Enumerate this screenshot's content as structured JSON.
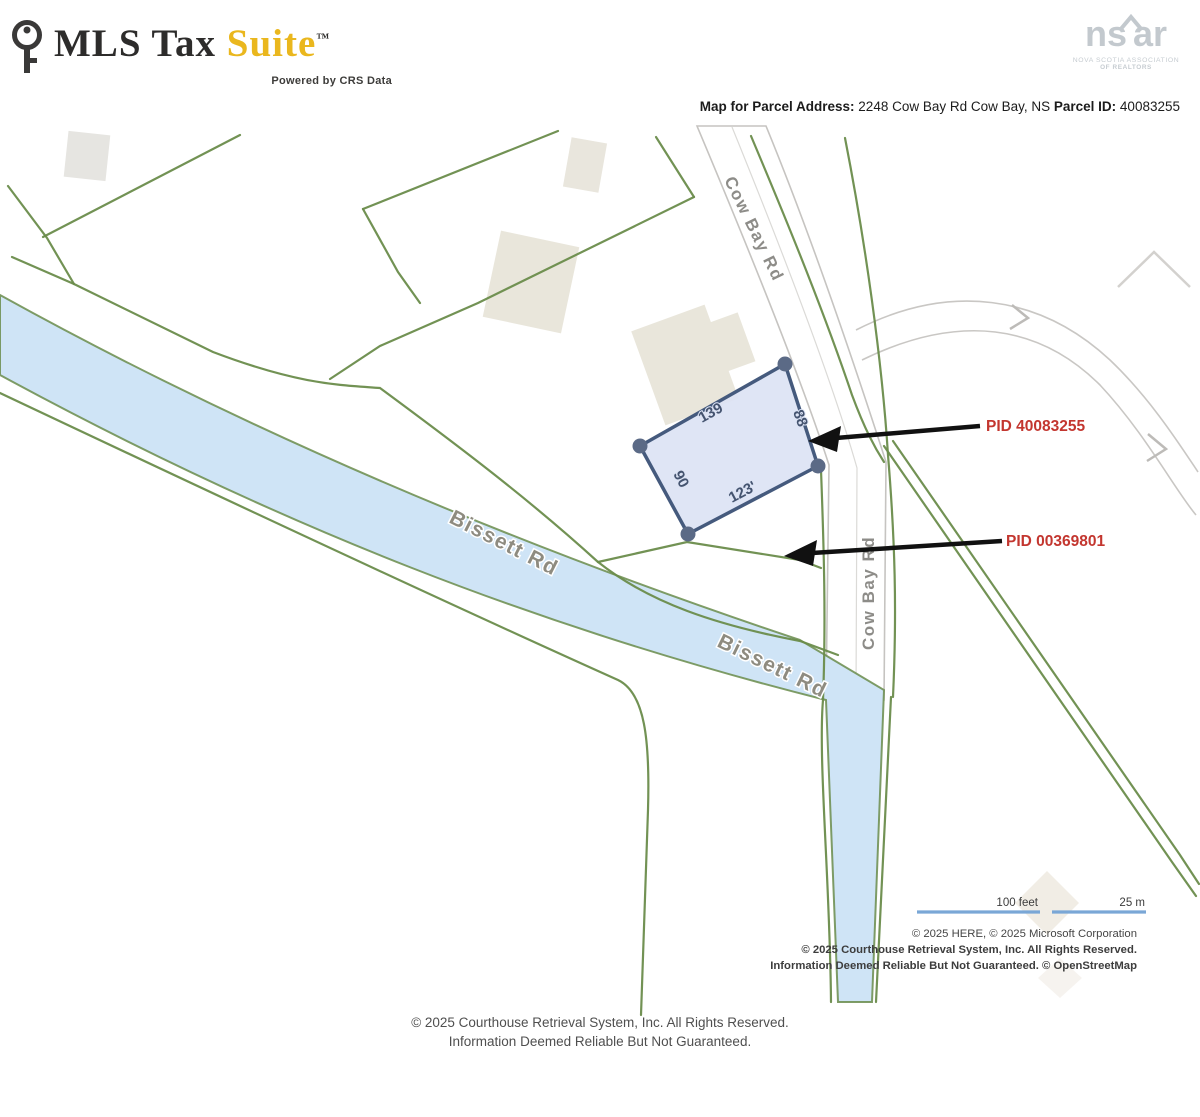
{
  "brand": {
    "name_dark": "MLS Tax",
    "name_gold": " Suite",
    "trademark": "™",
    "tagline": "Powered by CRS Data"
  },
  "nsar_logo": {
    "left": "ns",
    "right": "ar",
    "caption_line1": "NOVA SCOTIA ASSOCIATION",
    "caption_line2": "OF REALTORS"
  },
  "map_header": {
    "address_label": "Map for Parcel Address:",
    "address_value": " 2248 Cow Bay Rd Cow Bay, NS ",
    "parcel_id_label": "Parcel ID:",
    "parcel_id_value": " 40083255"
  },
  "map": {
    "street_labels": {
      "cow_bay_upper": "Cow Bay Rd",
      "cow_bay_lower": "Cow Bay Rd",
      "bissett_west": "Bissett Rd",
      "bissett_east": "Bissett Rd"
    },
    "subject_parcel": {
      "dim_top": "139",
      "dim_right": "88",
      "dim_bottom": "123'",
      "dim_left": "90"
    },
    "callouts": {
      "pid_subject": "PID 40083255",
      "pid_neighbor": "PID 00369801"
    },
    "scale": {
      "feet": "100 feet",
      "meters": "25 m"
    },
    "attribution_line1": "© 2025 HERE, © 2025 Microsoft Corporation",
    "attribution_line2": "© 2025 Courthouse Retrieval System, Inc. All Rights Reserved.",
    "attribution_line3": "Information Deemed Reliable But Not Guaranteed. © OpenStreetMap",
    "colors": {
      "parcel_line_green": "#6a8c4b",
      "road_blue_fill": "#cfe4f6",
      "subject_parcel_fill": "#dce3f4",
      "subject_parcel_border": "#455a7d",
      "pid_label_red": "#c3362f",
      "arrow_black": "#111111",
      "scale_bar_blue": "#7aa7d6",
      "brand_gold": "#eab71e"
    }
  },
  "footer": {
    "line1": "© 2025 Courthouse Retrieval System, Inc. All Rights Reserved.",
    "line2": "Information Deemed Reliable But Not Guaranteed."
  }
}
